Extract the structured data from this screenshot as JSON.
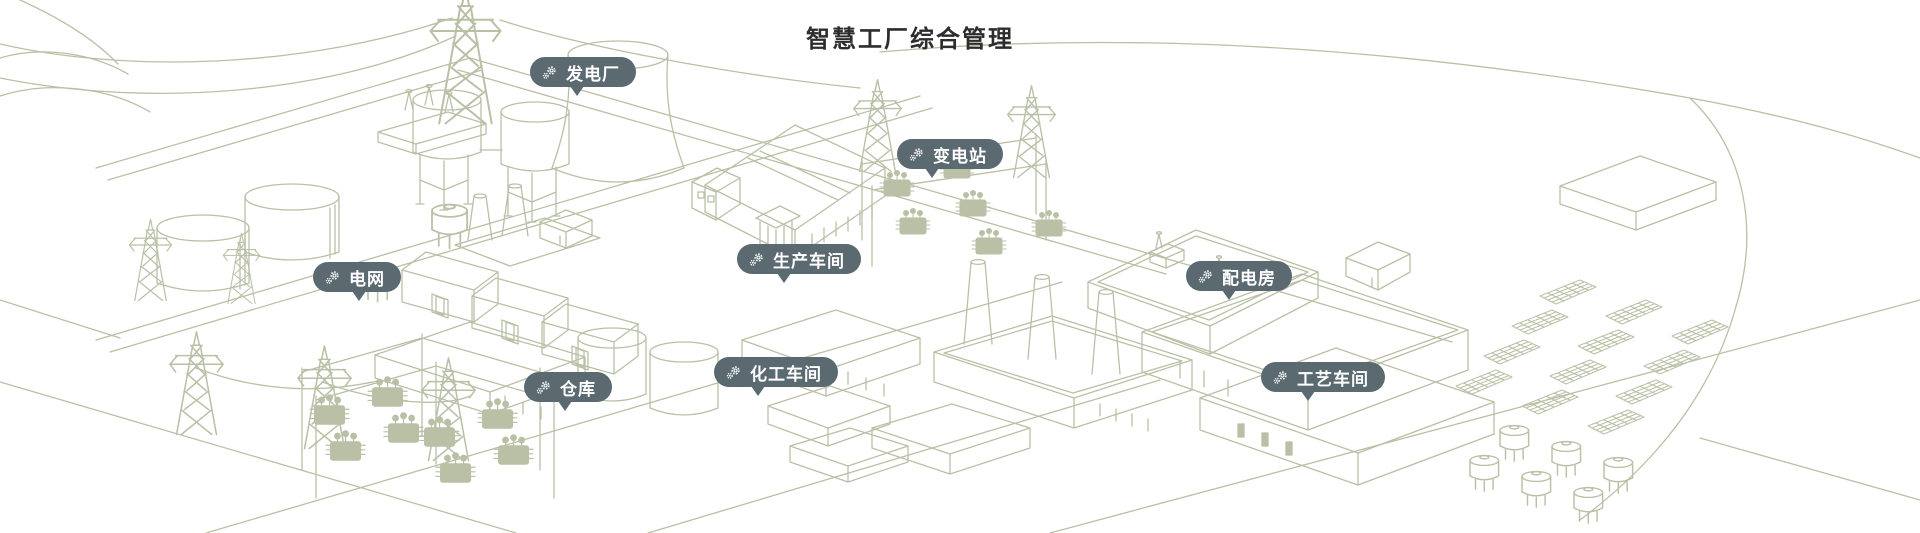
{
  "page": {
    "title": "智慧工厂综合管理"
  },
  "colors": {
    "background": "#ffffff",
    "line_art": "#b9c0a5",
    "badge_background": "#5b6971",
    "badge_text": "#ffffff",
    "title_text": "#2d2d2d"
  },
  "icons": {
    "badge_icon": "gears-icon"
  },
  "hotspots": [
    {
      "id": "power-plant",
      "label": "发电厂"
    },
    {
      "id": "substation",
      "label": "变电站"
    },
    {
      "id": "power-grid",
      "label": "电网"
    },
    {
      "id": "production-workshop",
      "label": "生产车间"
    },
    {
      "id": "distribution-room",
      "label": "配电房"
    },
    {
      "id": "warehouse",
      "label": "仓库"
    },
    {
      "id": "chemical-workshop",
      "label": "化工车间"
    },
    {
      "id": "process-workshop",
      "label": "工艺车间"
    }
  ]
}
